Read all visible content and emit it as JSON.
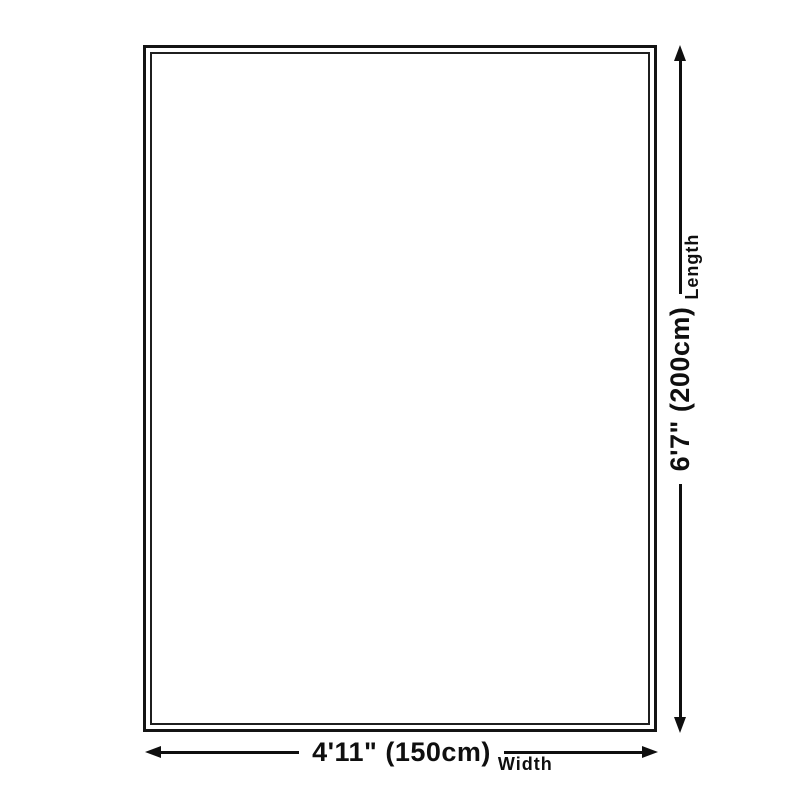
{
  "diagram": {
    "title": "product-size-diagram",
    "product_outline": {
      "shape": "rectangle",
      "border_style": "double-line"
    },
    "length": {
      "value": "6'7\" (200cm)",
      "label": "Length",
      "arrow": "double-headed-vertical"
    },
    "width": {
      "value": "4'11\" (150cm)",
      "label": "Width",
      "arrow": "double-headed-horizontal"
    },
    "colors": {
      "stroke": "#0f0f0f",
      "background": "#ffffff",
      "product_fill": "#ffffff"
    }
  }
}
